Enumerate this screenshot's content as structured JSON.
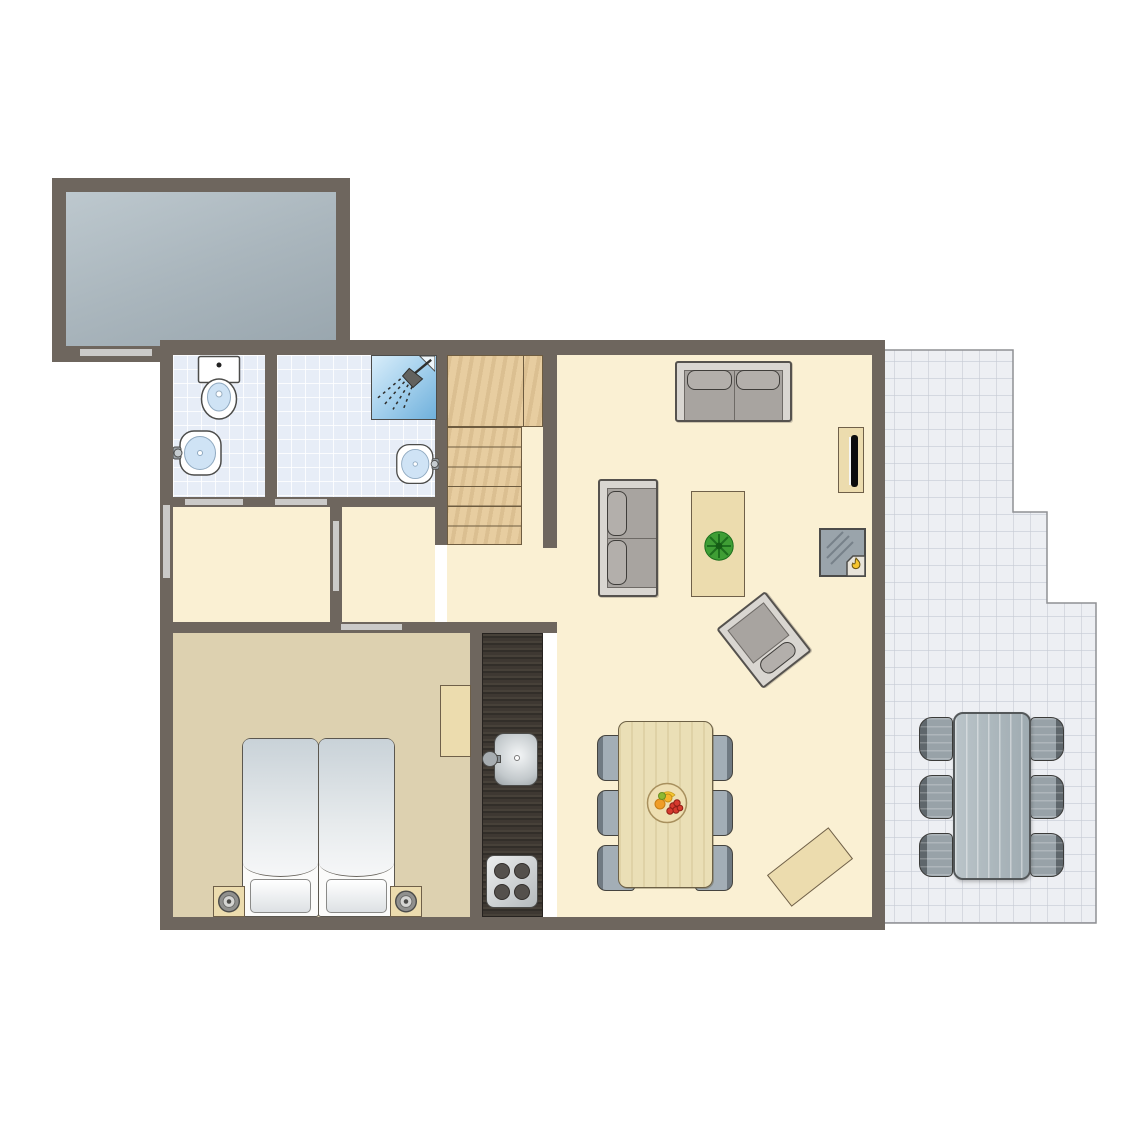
{
  "floorplan": {
    "canvas": {
      "width": 1145,
      "height": 1145,
      "background": "#ffffff"
    },
    "palette": {
      "wall": "#6e665e",
      "door": "#cbcac8",
      "floor_living": "#faf0d3",
      "floor_bedroom": "#ddd1b0",
      "bathroom_tile": "#e7edf7",
      "terrace_tile": "#edeff3",
      "garage_floor": "#aab6bd",
      "stair_wood": "#e7cda0",
      "kitchen_counter": "#383430",
      "furniture_wood": "#ecdcae",
      "sofa_gray": "#a8a4a0",
      "chair_gray_blue": "#a3aeb6",
      "outdoor_gray": "#98a2a8",
      "shower_blue": "#6fb0dc",
      "flame_yellow": "#f6c52e",
      "plant_green": "#3f9e35"
    },
    "elements": [
      {
        "name": "garage-floor",
        "type": "fill",
        "fill": "garage",
        "x": 66,
        "y": 192,
        "w": 270,
        "h": 154
      },
      {
        "name": "bathroom-wc-floor",
        "type": "fill",
        "fill": "tile",
        "x": 173,
        "y": 355,
        "w": 92,
        "h": 142
      },
      {
        "name": "bathroom-shower-floor",
        "type": "fill",
        "fill": "tile",
        "x": 277,
        "y": 355,
        "w": 158,
        "h": 142
      },
      {
        "name": "hallway-front-floor",
        "type": "fill",
        "fill": "cream",
        "x": 173,
        "y": 507,
        "w": 157,
        "h": 115
      },
      {
        "name": "hallway-inner-floor",
        "type": "fill",
        "fill": "cream",
        "x": 342,
        "y": 507,
        "w": 93,
        "h": 115
      },
      {
        "name": "hallway-understairs-floor",
        "type": "fill",
        "fill": "cream",
        "x": 447,
        "y": 545,
        "w": 110,
        "h": 77
      },
      {
        "name": "stairs-side-floor",
        "type": "fill",
        "fill": "cream",
        "x": 522,
        "y": 427,
        "w": 21,
        "h": 118
      },
      {
        "name": "living-room-floor",
        "type": "fill",
        "fill": "cream",
        "x": 557,
        "y": 355,
        "w": 315,
        "h": 562
      },
      {
        "name": "bedroom-floor",
        "type": "fill",
        "fill": "tan",
        "x": 173,
        "y": 633,
        "w": 297,
        "h": 284
      },
      {
        "name": "terrace-floor",
        "type": "terrace",
        "x": 877,
        "y": 344,
        "w": 223,
        "h": 583,
        "points": [
          [
            3,
            6
          ],
          [
            136,
            6
          ],
          [
            136,
            168
          ],
          [
            170,
            168
          ],
          [
            170,
            259
          ],
          [
            219,
            259
          ],
          [
            219,
            579
          ],
          [
            3,
            579
          ]
        ]
      },
      {
        "name": "kitchen-counter",
        "type": "counter",
        "x": 482,
        "y": 633,
        "w": 61,
        "h": 284
      },
      {
        "name": "staircase",
        "type": "stairs",
        "x": 447,
        "y": 355,
        "w": 96,
        "h": 190,
        "landing_h": 72,
        "tread_w": 75
      },
      {
        "name": "garage-wall-top",
        "type": "wall",
        "x": 52,
        "y": 178,
        "w": 298,
        "h": 14
      },
      {
        "name": "garage-wall-left",
        "type": "wall",
        "x": 52,
        "y": 178,
        "w": 14,
        "h": 184
      },
      {
        "name": "garage-wall-right",
        "type": "wall",
        "x": 336,
        "y": 178,
        "w": 14,
        "h": 168
      },
      {
        "name": "garage-wall-bottom",
        "type": "wall",
        "x": 52,
        "y": 346,
        "w": 112,
        "h": 16
      },
      {
        "name": "house-wall-top",
        "type": "wall",
        "x": 160,
        "y": 340,
        "w": 725,
        "h": 15
      },
      {
        "name": "house-wall-left",
        "type": "wall",
        "x": 160,
        "y": 340,
        "w": 13,
        "h": 590
      },
      {
        "name": "house-wall-right",
        "type": "wall",
        "x": 872,
        "y": 340,
        "w": 13,
        "h": 590
      },
      {
        "name": "house-wall-bottom",
        "type": "wall",
        "x": 160,
        "y": 917,
        "w": 725,
        "h": 13
      },
      {
        "name": "wall-bathroom-divider",
        "type": "wall",
        "x": 265,
        "y": 355,
        "w": 12,
        "h": 142
      },
      {
        "name": "wall-bathroom-stairs",
        "type": "wall",
        "x": 435,
        "y": 340,
        "w": 12,
        "h": 205
      },
      {
        "name": "wall-stairs-right",
        "type": "wall",
        "x": 543,
        "y": 340,
        "w": 14,
        "h": 208
      },
      {
        "name": "wall-below-bathrooms",
        "type": "wall",
        "x": 173,
        "y": 497,
        "w": 274,
        "h": 10
      },
      {
        "name": "wall-hallway-divider",
        "type": "wall",
        "x": 330,
        "y": 507,
        "w": 12,
        "h": 115
      },
      {
        "name": "wall-bedroom-top",
        "type": "wall",
        "x": 160,
        "y": 622,
        "w": 397,
        "h": 11
      },
      {
        "name": "wall-bedroom-kitchen",
        "type": "wall",
        "x": 470,
        "y": 633,
        "w": 12,
        "h": 284
      },
      {
        "name": "door-garage",
        "type": "door",
        "x": 80,
        "y": 349,
        "w": 72,
        "h": 7
      },
      {
        "name": "door-wc",
        "type": "door",
        "x": 185,
        "y": 499,
        "w": 58,
        "h": 6
      },
      {
        "name": "door-shower-room",
        "type": "door",
        "x": 275,
        "y": 499,
        "w": 52,
        "h": 6
      },
      {
        "name": "door-front",
        "type": "door",
        "x": 163,
        "y": 505,
        "w": 7,
        "h": 73
      },
      {
        "name": "door-hallway",
        "type": "door",
        "x": 333,
        "y": 521,
        "w": 6,
        "h": 70
      },
      {
        "name": "door-bedroom",
        "type": "door",
        "x": 341,
        "y": 624,
        "w": 61,
        "h": 6
      },
      {
        "name": "dining-chair-left-1",
        "type": "chair",
        "variant": "dining",
        "side": "left",
        "x": 597,
        "y": 735,
        "w": 38,
        "h": 46
      },
      {
        "name": "dining-chair-left-2",
        "type": "chair",
        "variant": "dining",
        "side": "left",
        "x": 597,
        "y": 790,
        "w": 38,
        "h": 46
      },
      {
        "name": "dining-chair-left-3",
        "type": "chair",
        "variant": "dining",
        "side": "left",
        "x": 597,
        "y": 845,
        "w": 38,
        "h": 46
      },
      {
        "name": "dining-chair-right-1",
        "type": "chair",
        "variant": "dining",
        "side": "right",
        "x": 695,
        "y": 735,
        "w": 38,
        "h": 46
      },
      {
        "name": "dining-chair-right-2",
        "type": "chair",
        "variant": "dining",
        "side": "right",
        "x": 695,
        "y": 790,
        "w": 38,
        "h": 46
      },
      {
        "name": "dining-chair-right-3",
        "type": "chair",
        "variant": "dining",
        "side": "right",
        "x": 695,
        "y": 845,
        "w": 38,
        "h": 46
      },
      {
        "name": "dining-table",
        "type": "table",
        "variant": "dining",
        "x": 618,
        "y": 721,
        "w": 95,
        "h": 167
      },
      {
        "name": "fruit-bowl",
        "type": "bowl",
        "x": 646,
        "y": 782,
        "w": 42,
        "h": 42
      },
      {
        "name": "terrace-chair-left-1",
        "type": "chair",
        "variant": "outdoor",
        "side": "left",
        "x": 919,
        "y": 717,
        "w": 34,
        "h": 44
      },
      {
        "name": "terrace-chair-left-2",
        "type": "chair",
        "variant": "outdoor",
        "side": "left",
        "x": 919,
        "y": 775,
        "w": 34,
        "h": 44
      },
      {
        "name": "terrace-chair-left-3",
        "type": "chair",
        "variant": "outdoor",
        "side": "left",
        "x": 919,
        "y": 833,
        "w": 34,
        "h": 44
      },
      {
        "name": "terrace-chair-right-1",
        "type": "chair",
        "variant": "outdoor",
        "side": "right",
        "x": 1030,
        "y": 717,
        "w": 34,
        "h": 44
      },
      {
        "name": "terrace-chair-right-2",
        "type": "chair",
        "variant": "outdoor",
        "side": "right",
        "x": 1030,
        "y": 775,
        "w": 34,
        "h": 44
      },
      {
        "name": "terrace-chair-right-3",
        "type": "chair",
        "variant": "outdoor",
        "side": "right",
        "x": 1030,
        "y": 833,
        "w": 34,
        "h": 44
      },
      {
        "name": "terrace-table",
        "type": "table",
        "variant": "outdoor",
        "x": 953,
        "y": 712,
        "w": 78,
        "h": 168
      },
      {
        "name": "sofa-top",
        "type": "sofa",
        "dir": "h",
        "x": 675,
        "y": 361,
        "w": 117,
        "h": 61
      },
      {
        "name": "sofa-side",
        "type": "sofa",
        "dir": "v",
        "x": 598,
        "y": 479,
        "w": 60,
        "h": 118
      },
      {
        "name": "coffee-table",
        "type": "coffee",
        "x": 691,
        "y": 491,
        "w": 54,
        "h": 106
      },
      {
        "name": "tv-cabinet",
        "type": "tvcab",
        "x": 838,
        "y": 427,
        "w": 26,
        "h": 66
      },
      {
        "name": "fireplace",
        "type": "fireplace",
        "x": 819,
        "y": 528,
        "w": 47,
        "h": 49
      },
      {
        "name": "armchair",
        "type": "armchair",
        "x": 733,
        "y": 602,
        "w": 62,
        "h": 76,
        "rot": -38
      },
      {
        "name": "bench",
        "type": "wood",
        "x": 771,
        "y": 847,
        "w": 78,
        "h": 40,
        "rot": -38
      },
      {
        "name": "bed-left",
        "type": "bed",
        "x": 242,
        "y": 738,
        "w": 77,
        "h": 179
      },
      {
        "name": "bed-right",
        "type": "bed",
        "x": 318,
        "y": 738,
        "w": 77,
        "h": 179
      },
      {
        "name": "nightstand-left",
        "type": "nightstand",
        "x": 213,
        "y": 886,
        "w": 32,
        "h": 31
      },
      {
        "name": "nightstand-right",
        "type": "nightstand",
        "x": 390,
        "y": 886,
        "w": 32,
        "h": 31
      },
      {
        "name": "bedroom-desk",
        "type": "wood",
        "x": 440,
        "y": 685,
        "w": 31,
        "h": 72
      },
      {
        "name": "kitchen-sink",
        "type": "sinkunit",
        "x": 482,
        "y": 733,
        "w": 56,
        "h": 53
      },
      {
        "name": "kitchen-stove",
        "type": "stove",
        "x": 486,
        "y": 855,
        "w": 52,
        "h": 53
      },
      {
        "name": "toilet",
        "type": "toilet",
        "x": 197,
        "y": 355,
        "w": 44,
        "h": 66
      },
      {
        "name": "wc-sink",
        "type": "wallsink",
        "side": "left",
        "x": 173,
        "y": 428,
        "w": 50,
        "h": 50
      },
      {
        "name": "shower-room-sink",
        "type": "wallsink",
        "side": "right",
        "x": 395,
        "y": 439,
        "w": 44,
        "h": 50
      },
      {
        "name": "shower",
        "type": "shower",
        "x": 371,
        "y": 355,
        "w": 66,
        "h": 65
      }
    ]
  }
}
